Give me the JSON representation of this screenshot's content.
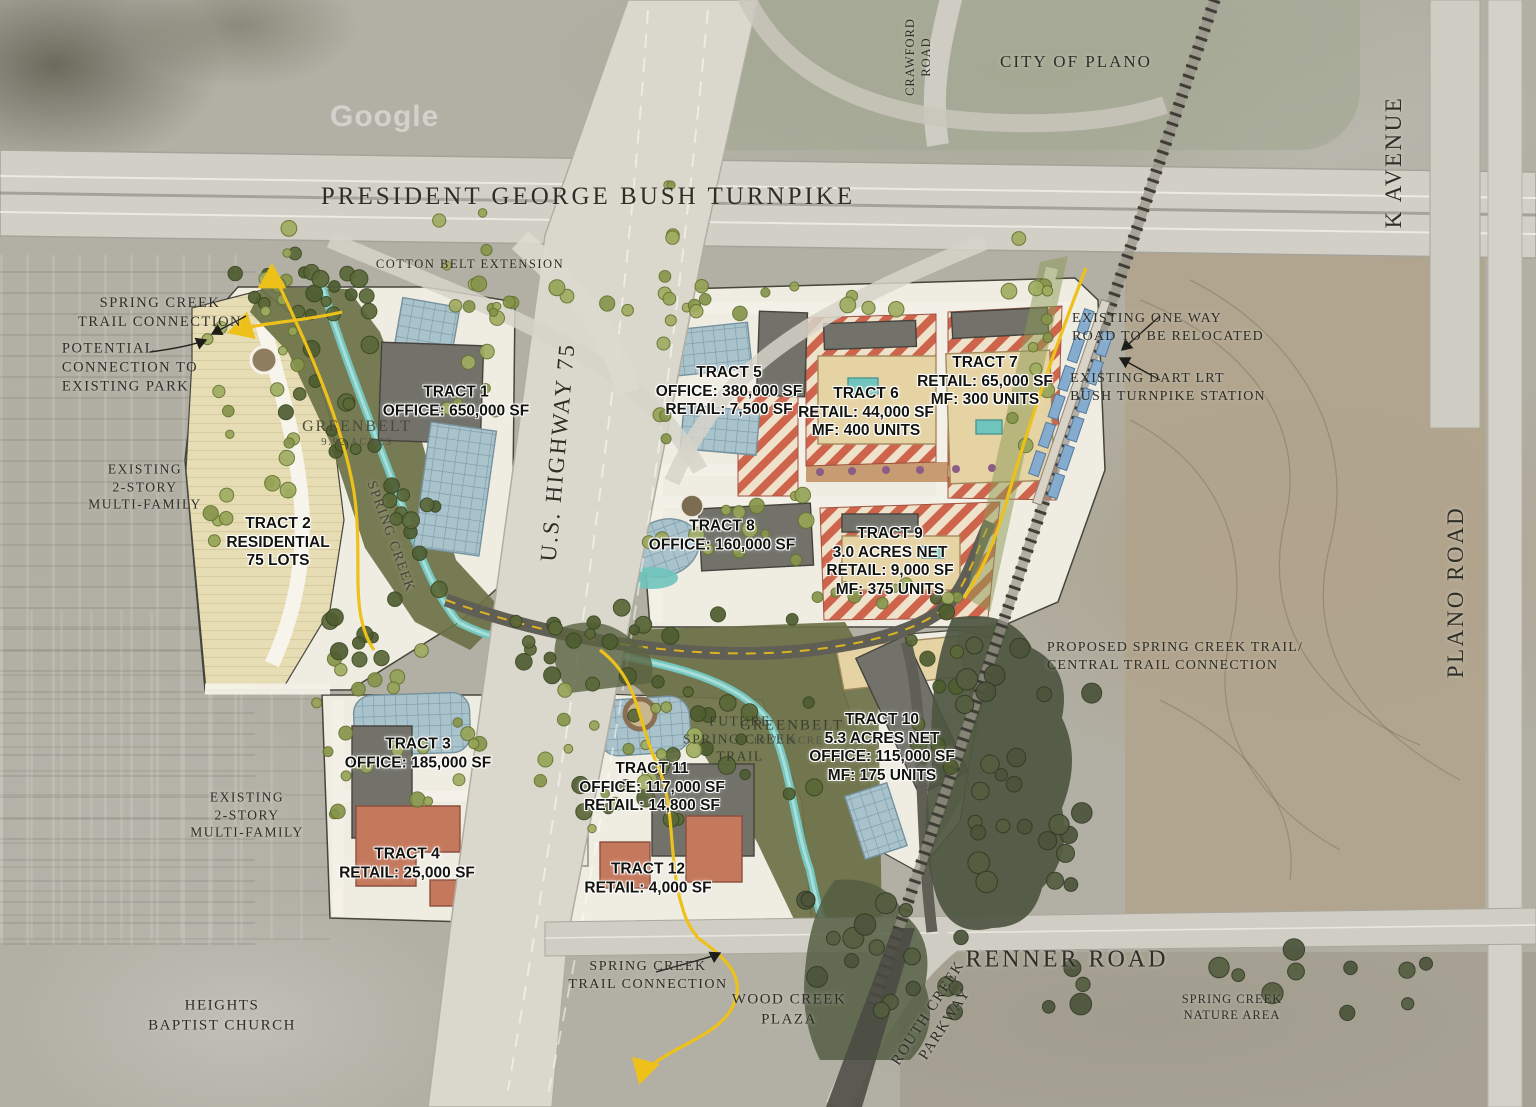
{
  "watermark": "Google",
  "roads": {
    "turnpike": "PRESIDENT GEORGE BUSH TURNPIKE",
    "cotton_belt": "COTTON BELT EXTENSION",
    "crawford": [
      "CRAWFORD",
      "ROAD"
    ],
    "k_avenue": "K AVENUE",
    "highway75": "U.S. HIGHWAY 75",
    "plano_road": "PLANO ROAD",
    "renner_road": "RENNER ROAD",
    "routh_creek": [
      "ROUTH CREEK",
      "PARKWAY"
    ]
  },
  "places": {
    "city_of_plano": "CITY OF PLANO",
    "heights_baptist": [
      "HEIGHTS",
      "BAPTIST CHURCH"
    ],
    "wood_creek_plaza": [
      "WOOD CREEK",
      "PLAZA"
    ],
    "spring_creek_nature": [
      "SPRING CREEK",
      "NATURE AREA"
    ],
    "existing_mf_west": [
      "EXISTING",
      "2-STORY",
      "MULTI-FAMILY"
    ],
    "existing_mf_south": [
      "EXISTING",
      "2-STORY",
      "MULTI-FAMILY"
    ]
  },
  "annotations": {
    "spring_creek_trail_nw": [
      "SPRING CREEK",
      "TRAIL CONNECTION"
    ],
    "potential_connection": [
      "POTENTIAL",
      "CONNECTION TO",
      "EXISTING PARK"
    ],
    "one_way": [
      "EXISTING ONE WAY",
      "ROAD TO BE RELOCATED"
    ],
    "dart": [
      "EXISTING DART LRT",
      "BUSH TURNPIKE STATION"
    ],
    "proposed_trail": [
      "PROPOSED SPRING CREEK TRAIL/",
      "CENTRAL TRAIL CONNECTION"
    ],
    "future_trail": [
      "FUTURE",
      "SPRING CREEK",
      "TRAIL"
    ],
    "spring_creek_trail_s": [
      "SPRING CREEK",
      "TRAIL CONNECTION"
    ],
    "spring_creek_label": "SPRING CREEK"
  },
  "greenbelts": [
    {
      "name": "GREENBELT",
      "acres": "9.92 ACRES"
    },
    {
      "name": "GREENBELT",
      "acres": "10.72 ACRES"
    }
  ],
  "tracts": [
    {
      "name": "TRACT 1",
      "details": [
        "OFFICE: 650,000 SF"
      ]
    },
    {
      "name": "TRACT 2",
      "details": [
        "RESIDENTIAL",
        "75 LOTS"
      ]
    },
    {
      "name": "TRACT 3",
      "details": [
        "OFFICE: 185,000 SF"
      ]
    },
    {
      "name": "TRACT 4",
      "details": [
        "RETAIL: 25,000 SF"
      ]
    },
    {
      "name": "TRACT 5",
      "details": [
        "OFFICE: 380,000 SF",
        "RETAIL: 7,500 SF"
      ]
    },
    {
      "name": "TRACT 6",
      "details": [
        "RETAIL: 44,000 SF",
        "MF: 400 UNITS"
      ]
    },
    {
      "name": "TRACT 7",
      "details": [
        "RETAIL: 65,000 SF",
        "MF: 300 UNITS"
      ]
    },
    {
      "name": "TRACT 8",
      "details": [
        "OFFICE: 160,000 SF"
      ]
    },
    {
      "name": "TRACT 9",
      "details": [
        "3.0 ACRES NET",
        "RETAIL: 9,000 SF",
        "MF: 375 UNITS"
      ]
    },
    {
      "name": "TRACT 10",
      "details": [
        "5.3 ACRES NET",
        "OFFICE: 115,000 SF",
        "MF: 175 UNITS"
      ]
    },
    {
      "name": "TRACT 11",
      "details": [
        "OFFICE: 117,000 SF",
        "RETAIL: 14,800 SF"
      ]
    },
    {
      "name": "TRACT 12",
      "details": [
        "RETAIL: 4,000 SF"
      ]
    }
  ],
  "colors": {
    "office_building": "#a9c3cc",
    "retail_building": "#c4785c",
    "mixed_use_stripe": "#cf5f46",
    "greenbelt": "#6d7146",
    "creek": "#74c6bf",
    "trail": "#eec11a"
  }
}
